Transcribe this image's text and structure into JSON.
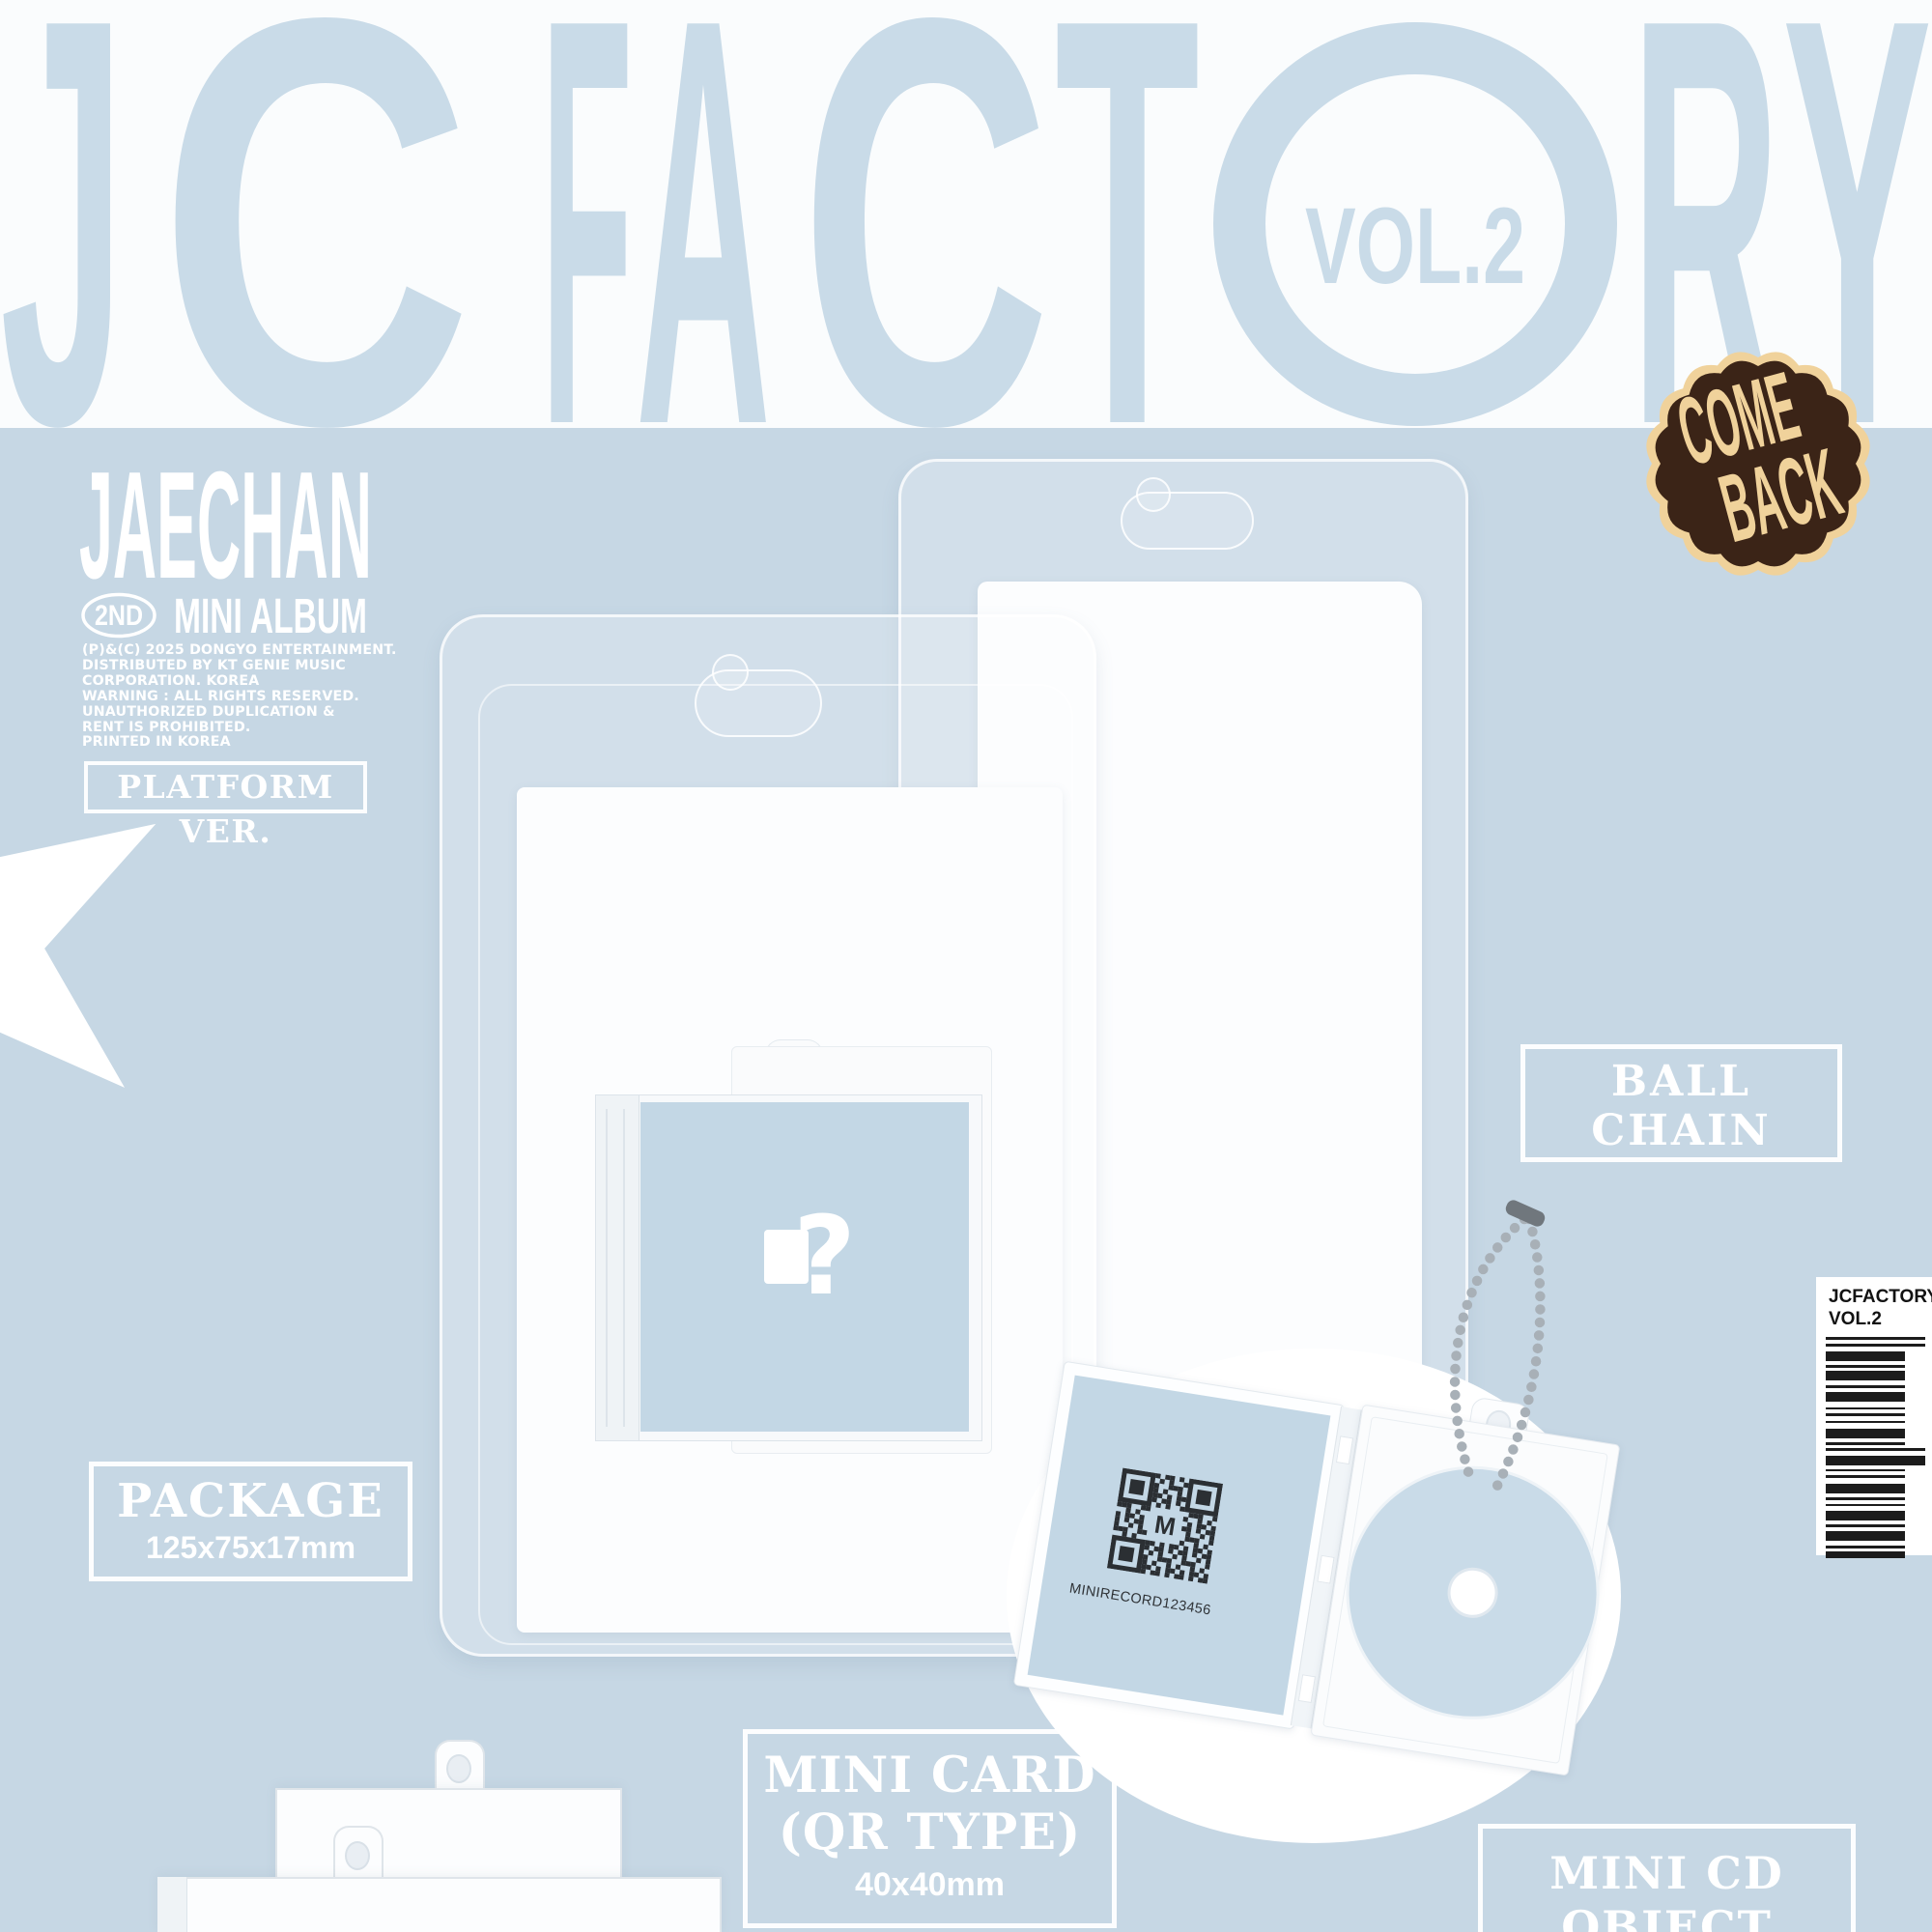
{
  "page_title": "JCFACTORY VOL.2",
  "headline": {
    "full": "JCFACTORY",
    "letters_left": [
      "J",
      "C",
      "F",
      "A",
      "C",
      "T"
    ],
    "letters_right": [
      "R",
      "Y"
    ],
    "vol": "VOL.2"
  },
  "badge": {
    "line1": "COME",
    "line2": "BACK"
  },
  "artist": {
    "name": "JAECHAN",
    "edition_badge": "2ND",
    "edition_text": "MINI ALBUM"
  },
  "copyright_lines": [
    "(P)&(C) 2025 DONGYO ENTERTAINMENT.",
    "DISTRIBUTED BY KT GENIE MUSIC",
    "CORPORATION. KOREA",
    "WARNING : ALL RIGHTS RESERVED.",
    "UNAUTHORIZED DUPLICATION &",
    "RENT IS PROHIBITED.",
    "PRINTED IN KOREA"
  ],
  "version_label": "PLATFORM VER.",
  "labels": {
    "ball_chain_line1": "BALL",
    "ball_chain_line2": "CHAIN",
    "package_title": "PACKAGE",
    "package_size": "125x75x17mm",
    "mini_card_line1": "MINI CARD",
    "mini_card_line2": "(QR TYPE)",
    "mini_card_size": "40x40mm",
    "mini_cd_line1": "MINI CD",
    "mini_cd_line2": "OBJECT"
  },
  "mini_record": {
    "qr_caption": "MINIRECORD123456",
    "qr_center_letter": "M",
    "cover_mark": "?"
  },
  "barcode": {
    "line1": "JCFACTORY",
    "line2": "VOL.2",
    "bars": [
      [
        3,
        4,
        1
      ],
      [
        3,
        5,
        1
      ],
      [
        10,
        4,
        0
      ],
      [
        3,
        3,
        0
      ],
      [
        10,
        5,
        0
      ],
      [
        3,
        4,
        0
      ],
      [
        10,
        6,
        0
      ],
      [
        2,
        4,
        0
      ],
      [
        3,
        5,
        0
      ],
      [
        2,
        6,
        0
      ],
      [
        10,
        4,
        0
      ],
      [
        3,
        3,
        0
      ],
      [
        3,
        5,
        1
      ],
      [
        10,
        4,
        1
      ],
      [
        2,
        4,
        0
      ],
      [
        3,
        6,
        0
      ],
      [
        10,
        4,
        0
      ],
      [
        3,
        4,
        0
      ],
      [
        2,
        5,
        0
      ],
      [
        10,
        4,
        0
      ],
      [
        3,
        4,
        0
      ],
      [
        10,
        5,
        0
      ],
      [
        3,
        3,
        0
      ],
      [
        7,
        0,
        0
      ]
    ]
  },
  "colors": {
    "background": "#c6d7e4",
    "band_white": "#fafcfd",
    "headline_blue": "#c9dbe8",
    "badge_brown": "#3b2417",
    "badge_cream": "#f0d29b",
    "label_white": "#ffffff",
    "cover_blue": "#c3d7e5",
    "disc_blue": "#c9dbe8",
    "chain_gray": "#a8b0b7",
    "barcode_black": "#1c1c1c"
  }
}
